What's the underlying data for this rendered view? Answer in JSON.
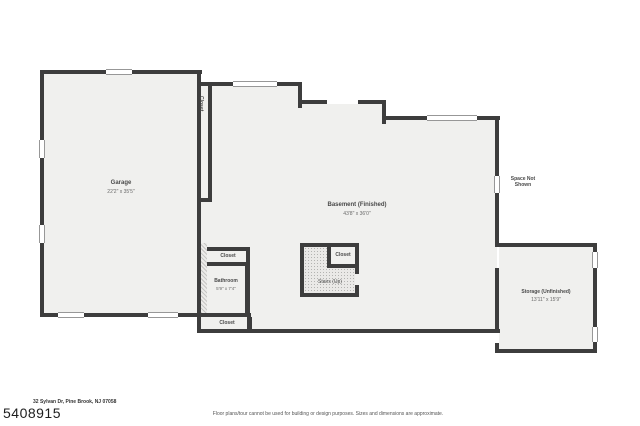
{
  "document": {
    "address": "32 Sylvan Dr, Pine Brook, NJ 07058",
    "listing_number": "5408915",
    "disclaimer": "Floor plans/tour cannot be used for building or design purposes. Sizes and dimensions are approximate."
  },
  "floorplan": {
    "rooms": {
      "garage": {
        "label": "Garage",
        "dimensions": "22'2\" x 35'5\""
      },
      "basement": {
        "label": "Basement (Finished)",
        "dimensions": "43'8\" x 36'0\""
      },
      "bathroom": {
        "label": "Bathroom",
        "dimensions": "5'9\" x 7'4\""
      },
      "storage": {
        "label": "Storage (Unfinished)",
        "dimensions": "13'11\" x 15'9\""
      },
      "stairs": {
        "label": "Stairs (Up)"
      },
      "closet_hall": {
        "label": "Closet"
      },
      "closet_upper": {
        "label": "Closet"
      },
      "closet_lower": {
        "label": "Closet"
      },
      "closet_stairs": {
        "label": "Closet"
      }
    },
    "annotations": {
      "space_not_shown": "Space Not\nShown"
    }
  },
  "colors": {
    "wall": "#3d3d3d",
    "room_fill": "#f0f0ee",
    "stipple_fill": "#eae9e7",
    "background": "#ffffff",
    "text": "#4a4a4a"
  }
}
